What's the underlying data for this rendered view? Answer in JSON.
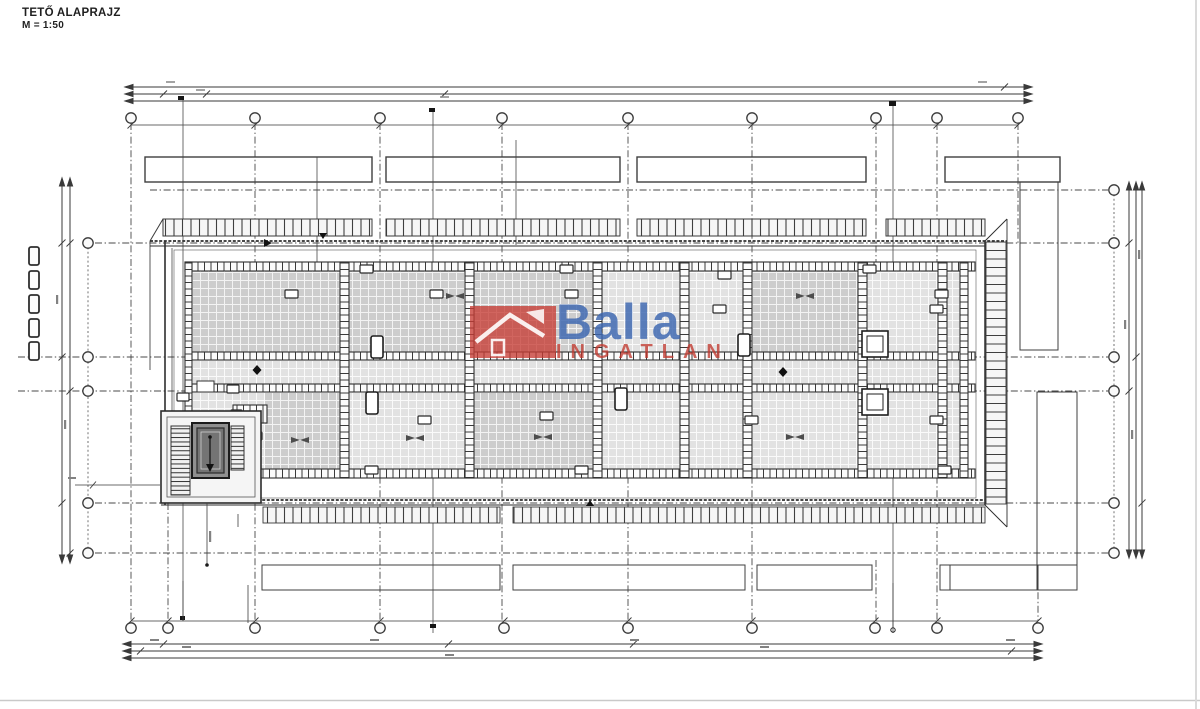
{
  "title": {
    "main": "TETŐ ALAPRAJZ",
    "scale": "M = 1:50"
  },
  "watermark": {
    "brand": "Balla",
    "subtitle": "INGATLAN",
    "brand_color": "#3e68b0",
    "subtitle_color": "#c0382e",
    "logo_background": "#c63c34",
    "logo_icon": "house-icon"
  },
  "drawing": {
    "ink_color": "#3a3a3a",
    "tile_fill_mid": "#cdcdcd",
    "tile_fill_light": "#e2e2e2",
    "elevator_shaft_fill": "#8f8f8f",
    "background": "#ffffff",
    "grid_marker_shape": "circle"
  }
}
